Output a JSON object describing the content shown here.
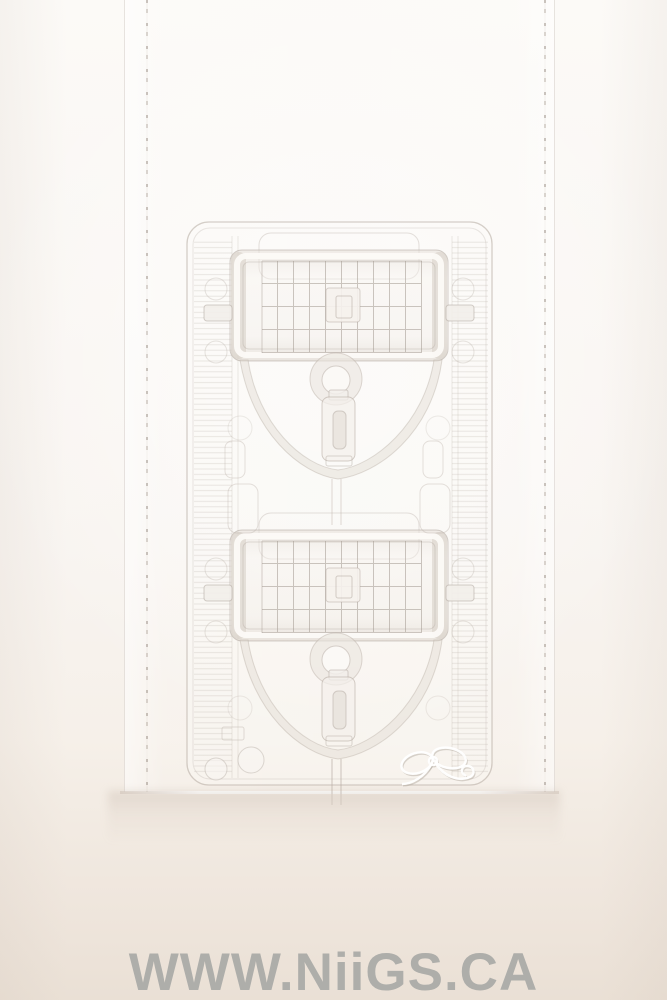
{
  "scene": {
    "kind": "product-photo",
    "subject": "Clear two-pocket vacuum-formed blister insert standing inside a clear acrylic sleeve on a seamless white studio backdrop",
    "pocket_count": "2"
  },
  "watermark": {
    "text": "WWW.NiiGS.CA",
    "color": "#a9aaa7"
  },
  "icons": {
    "bow_logo": "bow-ribbon-emboss-icon"
  },
  "palette": {
    "background_top": "#fcfaf7",
    "background_mid": "#f8f4f0",
    "surface_top": "#f3ece4",
    "surface_bottom": "#eae0d5",
    "plastic_line": "#b3a89e",
    "plastic_soft": "#d8d1ca",
    "highlight": "#ffffff"
  }
}
